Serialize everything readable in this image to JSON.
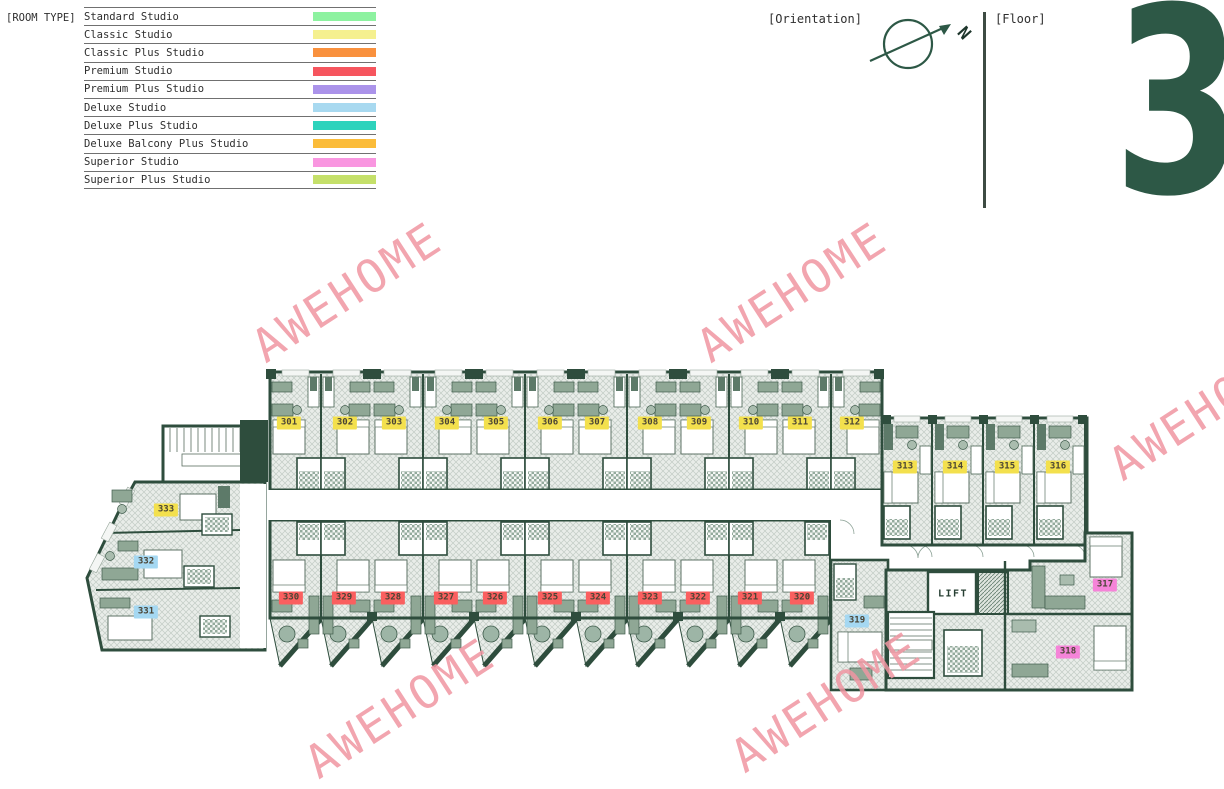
{
  "legend": {
    "title": "[ROOM TYPE]",
    "items": [
      {
        "label": "Standard Studio",
        "color": "#8df2a0"
      },
      {
        "label": "Classic Studio",
        "color": "#f5f08f"
      },
      {
        "label": "Classic Plus Studio",
        "color": "#f9913e"
      },
      {
        "label": "Premium Studio",
        "color": "#f6555e"
      },
      {
        "label": "Premium Plus Studio",
        "color": "#ab93ea"
      },
      {
        "label": "Deluxe Studio",
        "color": "#a8d9f0"
      },
      {
        "label": "Deluxe Plus Studio",
        "color": "#2ed3bc"
      },
      {
        "label": "Deluxe Balcony Plus Studio",
        "color": "#fbbc3a"
      },
      {
        "label": "Superior Studio",
        "color": "#f996e0"
      },
      {
        "label": "Superior Plus Studio",
        "color": "#c5e06a"
      }
    ]
  },
  "orientation": {
    "label": "[Orientation]",
    "north": "N"
  },
  "floor": {
    "label": "[Floor]",
    "number": "3"
  },
  "watermark": {
    "text": "AWEHOME",
    "color": "#f096a2",
    "positions": [
      {
        "x": 347,
        "y": 292
      },
      {
        "x": 792,
        "y": 292
      },
      {
        "x": 1204,
        "y": 410
      },
      {
        "x": 400,
        "y": 708
      },
      {
        "x": 826,
        "y": 702
      }
    ]
  },
  "plan": {
    "lift_label": "LIFT",
    "type_label_colors": {
      "Classic Studio": "#f3e04d",
      "Premium Studio": "#fa5f5f",
      "Deluxe Studio": "#a5d8f2",
      "Superior Studio": "#f584d8"
    },
    "rooms": [
      {
        "number": "301",
        "type": "Classic Studio",
        "x": 289,
        "y": 423
      },
      {
        "number": "302",
        "type": "Classic Studio",
        "x": 345,
        "y": 423
      },
      {
        "number": "303",
        "type": "Classic Studio",
        "x": 394,
        "y": 423
      },
      {
        "number": "304",
        "type": "Classic Studio",
        "x": 447,
        "y": 423
      },
      {
        "number": "305",
        "type": "Classic Studio",
        "x": 496,
        "y": 423
      },
      {
        "number": "306",
        "type": "Classic Studio",
        "x": 550,
        "y": 423
      },
      {
        "number": "307",
        "type": "Classic Studio",
        "x": 597,
        "y": 423
      },
      {
        "number": "308",
        "type": "Classic Studio",
        "x": 650,
        "y": 423
      },
      {
        "number": "309",
        "type": "Classic Studio",
        "x": 699,
        "y": 423
      },
      {
        "number": "310",
        "type": "Classic Studio",
        "x": 751,
        "y": 423
      },
      {
        "number": "311",
        "type": "Classic Studio",
        "x": 800,
        "y": 423
      },
      {
        "number": "312",
        "type": "Classic Studio",
        "x": 852,
        "y": 423
      },
      {
        "number": "313",
        "type": "Classic Studio",
        "x": 905,
        "y": 467
      },
      {
        "number": "314",
        "type": "Classic Studio",
        "x": 955,
        "y": 467
      },
      {
        "number": "315",
        "type": "Classic Studio",
        "x": 1007,
        "y": 467
      },
      {
        "number": "316",
        "type": "Classic Studio",
        "x": 1058,
        "y": 467
      },
      {
        "number": "317",
        "type": "Superior Studio",
        "x": 1105,
        "y": 585
      },
      {
        "number": "318",
        "type": "Superior Studio",
        "x": 1068,
        "y": 652
      },
      {
        "number": "319",
        "type": "Deluxe Studio",
        "x": 857,
        "y": 621
      },
      {
        "number": "320",
        "type": "Premium Studio",
        "x": 802,
        "y": 598
      },
      {
        "number": "321",
        "type": "Premium Studio",
        "x": 750,
        "y": 598
      },
      {
        "number": "322",
        "type": "Premium Studio",
        "x": 698,
        "y": 598
      },
      {
        "number": "323",
        "type": "Premium Studio",
        "x": 650,
        "y": 598
      },
      {
        "number": "324",
        "type": "Premium Studio",
        "x": 598,
        "y": 598
      },
      {
        "number": "325",
        "type": "Premium Studio",
        "x": 550,
        "y": 598
      },
      {
        "number": "326",
        "type": "Premium Studio",
        "x": 495,
        "y": 598
      },
      {
        "number": "327",
        "type": "Premium Studio",
        "x": 446,
        "y": 598
      },
      {
        "number": "328",
        "type": "Premium Studio",
        "x": 393,
        "y": 598
      },
      {
        "number": "329",
        "type": "Premium Studio",
        "x": 344,
        "y": 598
      },
      {
        "number": "330",
        "type": "Premium Studio",
        "x": 291,
        "y": 598
      },
      {
        "number": "331",
        "type": "Deluxe Studio",
        "x": 146,
        "y": 612
      },
      {
        "number": "332",
        "type": "Deluxe Studio",
        "x": 146,
        "y": 562
      },
      {
        "number": "333",
        "type": "Classic Studio",
        "x": 166,
        "y": 510
      }
    ]
  }
}
